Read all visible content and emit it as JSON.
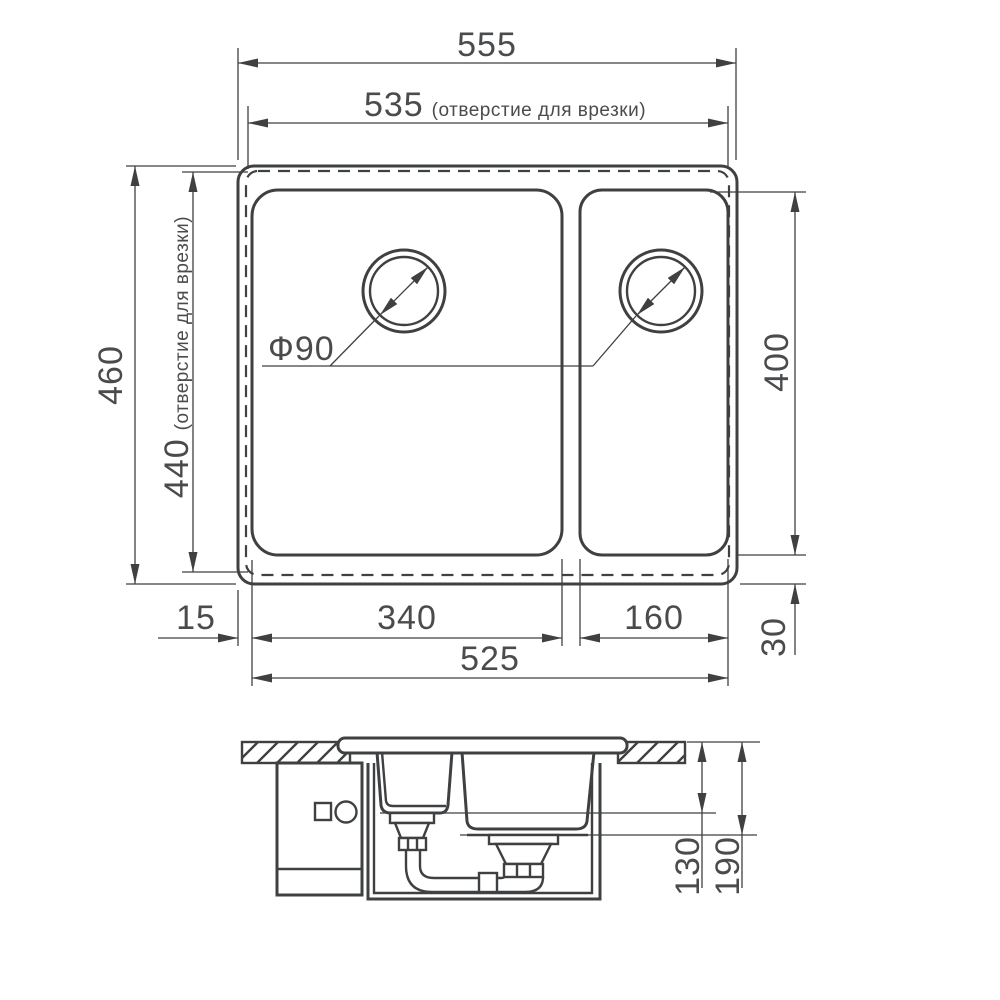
{
  "drawing": {
    "title": "sink-installation-dimensions",
    "colors": {
      "line": "#3f4042",
      "text": "#4a4b4d",
      "background": "#ffffff"
    },
    "top_view": {
      "dim_overall_width": {
        "value": "555"
      },
      "dim_cutout_width": {
        "value": "535",
        "note": "(отверстие для врезки)"
      },
      "dim_overall_depth": {
        "value": "460"
      },
      "dim_cutout_depth": {
        "value": "440",
        "note": "(отверстие для врезки)"
      },
      "dim_bowl_depth_span": {
        "value": "400"
      },
      "dim_bottom_gap": {
        "value": "30"
      },
      "dim_left_gap": {
        "value": "15"
      },
      "dim_main_bowl_width": {
        "value": "340"
      },
      "dim_small_bowl_width": {
        "value": "160"
      },
      "dim_bowls_total_width": {
        "value": "525"
      },
      "drain_diameter": {
        "value": "Ф90"
      }
    },
    "section_view": {
      "dim_small_bowl_depth": {
        "value": "130"
      },
      "dim_main_bowl_depth": {
        "value": "190"
      }
    }
  }
}
